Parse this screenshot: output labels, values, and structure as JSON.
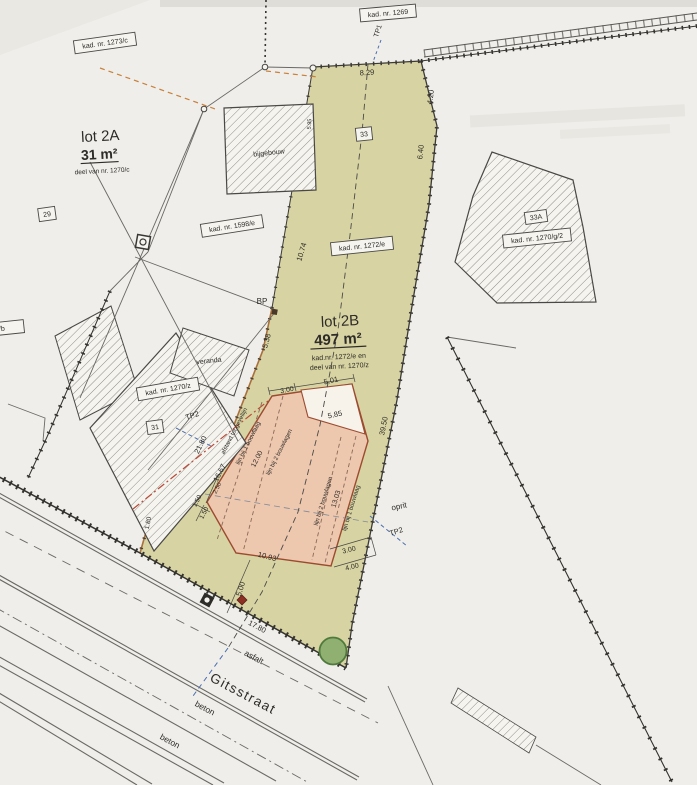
{
  "plan": {
    "street": {
      "name": "Gitsstraat",
      "asfalt": "asfalt",
      "beton": "beton",
      "beton2": "beton"
    },
    "lot2a": {
      "title": "lot 2A",
      "area": "31 m²",
      "note": "deel van nr. 1270/c"
    },
    "lot2b": {
      "title": "lot 2B",
      "area": "497 m²",
      "note1": "kad.nr. 1272/e en",
      "note2": "deel van nr. 1270/z"
    },
    "kad": {
      "k1273c": "kad. nr. 1273/c",
      "k1269": "kad. nr. 1269",
      "k1598e": "kad. nr. 1598/e",
      "k1272e": "kad. nr. 1272/e",
      "k1270z": "kad. nr. 1270/z",
      "k1270g2": "kad. nr. 1270/g/2",
      "clipped": "2/e2/b"
    },
    "numbers": {
      "n29": "29",
      "n31": "31",
      "n33": "33",
      "n33a": "33A"
    },
    "buildings": {
      "bijgebouw": "bijgebouw",
      "veranda": "veranda"
    },
    "points": {
      "bp": "BP",
      "tp1": "TP1",
      "tp2a": "TP2",
      "tp2b": "TP2"
    },
    "annotations": {
      "oprit": "oprit",
      "red_line": "afstand tot gevellijn",
      "l1_left": "lijn bij 1 bouwlaag",
      "l2_left": "lijn bij 2 bouwlagen",
      "l2_right": "lijn bij 2 bouwlagen",
      "l1_right": "lijn bij 1 bouwlaag"
    },
    "dims": {
      "d829": "8.29",
      "d420": "4.20",
      "d640": "6.40",
      "d595": "5.95",
      "d1074": "10.74",
      "d538": "5.38",
      "d3950": "39.50",
      "d2180": "21.80",
      "d1667": "16.67",
      "d250": "2.50",
      "d150a": "1.50",
      "d150b": "1.50",
      "d180": "1.80",
      "d300t": "3.00",
      "d501": "5.01",
      "d585": "5.85",
      "d1200": "12.00",
      "d1303": "13.03",
      "d1093": "10.93",
      "d500": "5.00",
      "d1780": "17.80",
      "d300b": "3.00",
      "d400": "4.00"
    },
    "colors": {
      "parcel_green": "#d7d3a2",
      "building_pink": "#edc7ae",
      "boundary": "#3c3a36",
      "red_line": "#bb4a38",
      "blue": "#4a6fae",
      "orange": "#c8813c",
      "tree": "#8fb070"
    }
  }
}
